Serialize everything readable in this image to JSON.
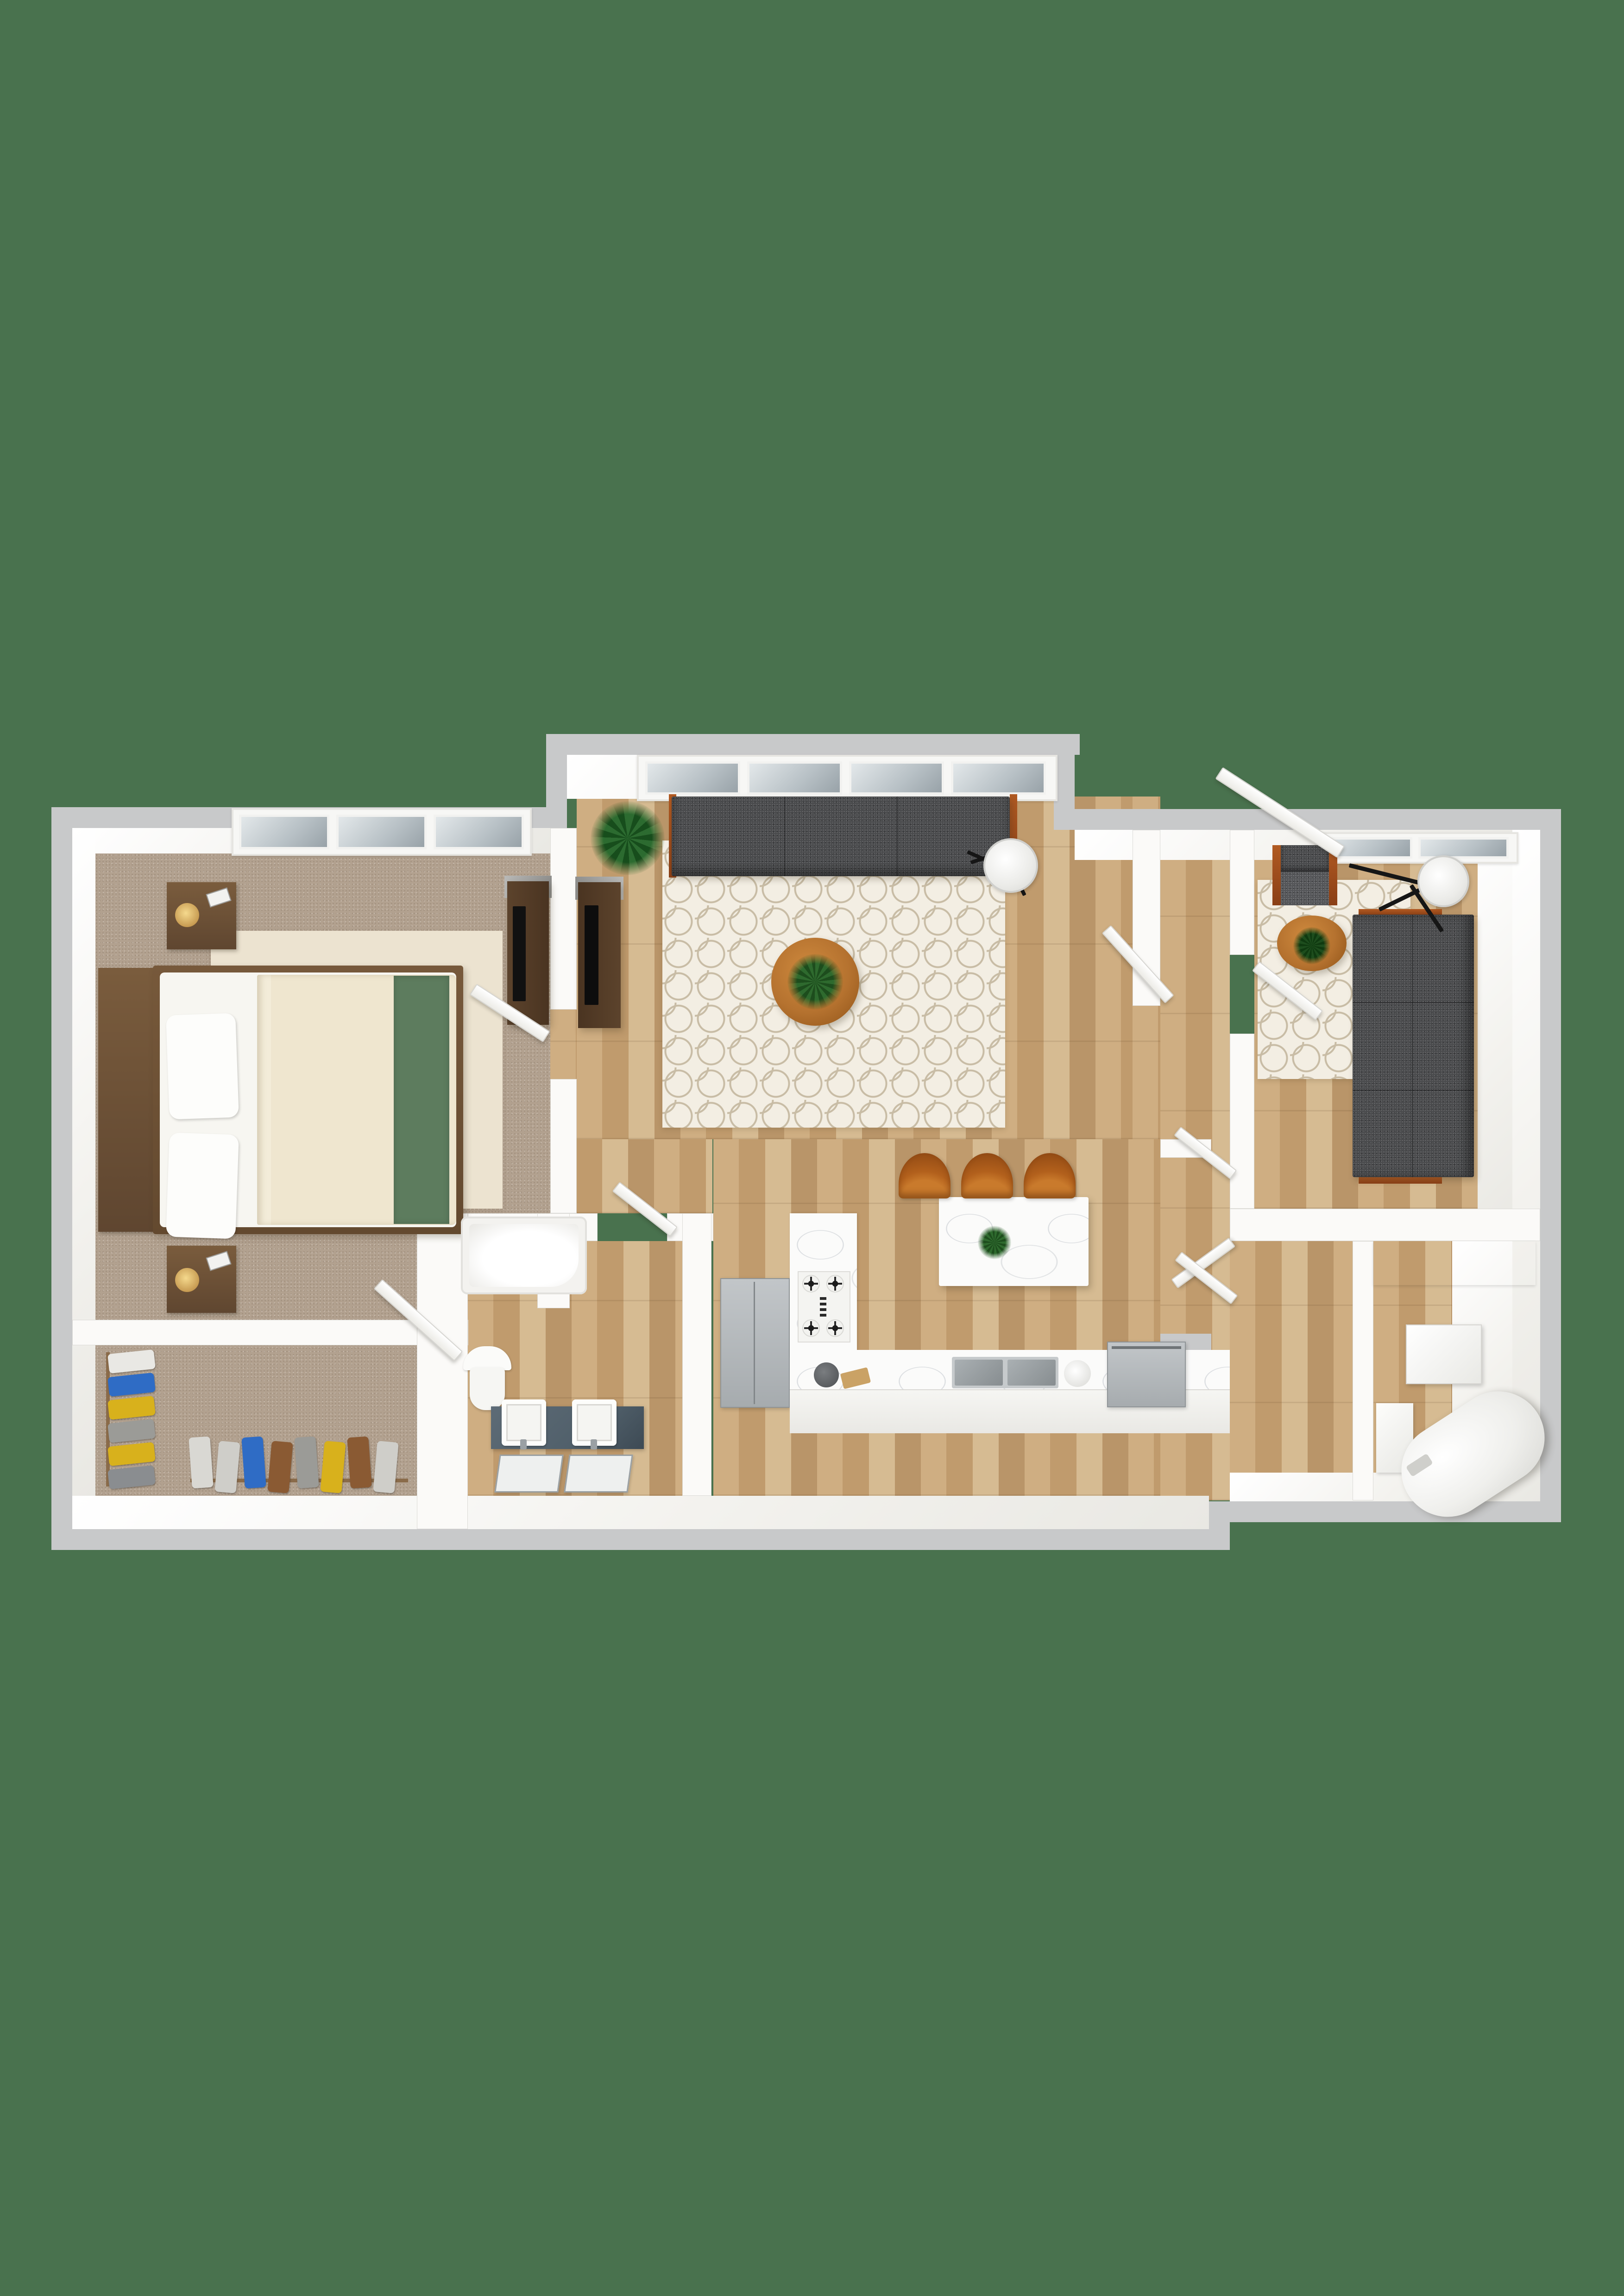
{
  "scene": {
    "type": "3d-floor-plan-rendering",
    "view": "top-down",
    "background_color": "#49724e",
    "text_content": "none"
  },
  "palette": {
    "bg_green": "#49724e",
    "wall_top": "#c8c9ca",
    "wall_white": "#fbfaf8",
    "wood_mid": "#c6a577",
    "carpet": "#b2a18f",
    "rug_cream": "#ece3d0",
    "rug_trellis_bg": "#f3eee3",
    "sofa_gray": "#4a4b4d",
    "sofa_wood_trim": "#a0522b",
    "table_wood": "#b5722f",
    "chair_wood": "#b2601c",
    "marble": "#fbfbfa",
    "stainless": "#aeb2b5",
    "vanity_slate": "#51606b",
    "bed_wood": "#6e5137",
    "bed_sheet": "#efe6cf",
    "bed_runner_green": "#5d7c5e",
    "plant_green": "#2e6a2e",
    "glass": "#b7c0c5"
  },
  "rooms": [
    {
      "id": "bedroom",
      "floor": "carpet",
      "features": [
        "window",
        "area-rug"
      ]
    },
    {
      "id": "living-room",
      "floor": "wood",
      "features": [
        "window",
        "trellis-rug"
      ]
    },
    {
      "id": "kitchen",
      "floor": "wood",
      "features": [
        "island",
        "l-counter"
      ]
    },
    {
      "id": "bathroom",
      "floor": "wood",
      "features": [
        "bathtub",
        "toilet",
        "double-vanity"
      ]
    },
    {
      "id": "walk-in-closet",
      "floor": "carpet",
      "features": [
        "hanging-clothes"
      ]
    },
    {
      "id": "den",
      "floor": "wood",
      "features": [
        "window",
        "trellis-rug"
      ]
    },
    {
      "id": "utility-room",
      "floor": "wood",
      "features": [
        "water-heater",
        "cabinet",
        "counter"
      ]
    },
    {
      "id": "entry-hall",
      "floor": "wood",
      "features": [
        "entry-door",
        "closet-doors"
      ]
    }
  ],
  "furniture": [
    "bed",
    "headboard",
    "pillows",
    "green-bed-runner",
    "nightstand-with-lamp",
    "nightstand-with-lamp",
    "bedroom-dresser-tv",
    "living-sofa",
    "living-coffee-table",
    "living-floor-lamp",
    "potted-plant",
    "tv-console",
    "kitchen-island",
    "bar-chair",
    "bar-chair",
    "bar-chair",
    "gas-cooktop",
    "double-sink",
    "refrigerator",
    "stainless-appliance",
    "kettle",
    "cutting-board",
    "coffee-maker",
    "bathtub",
    "toilet",
    "vanity-sink",
    "vanity-sink",
    "leaning-mirror",
    "leaning-mirror",
    "den-armchair",
    "den-sofa",
    "den-coffee-table",
    "den-floor-lamp",
    "water-heater",
    "wall-cabinet",
    "utility-counter",
    "utility-box"
  ],
  "closet": {
    "left_rack": [
      "#e9e8e4",
      "#2f6cc5",
      "#d8b11c",
      "#9b9b97",
      "#d8b11c",
      "#8a8d90"
    ],
    "bottom_rack": [
      "#d9d8d3",
      "#cfcec9",
      "#2f6cc5",
      "#8a5a33",
      "#9b9b97",
      "#d8b11c",
      "#8a5a33",
      "#cfcec9"
    ]
  },
  "windows": [
    {
      "room": "bedroom",
      "panes": 3
    },
    {
      "room": "living-room",
      "panes": 4
    },
    {
      "room": "den",
      "panes": 2
    }
  ],
  "doors_open": [
    "entry-door",
    "bedroom-door",
    "bathroom-door",
    "closet-door",
    "den-door",
    "hall-closet-door",
    "hall-closet-door",
    "hall-closet-door",
    "living-closet-door"
  ]
}
